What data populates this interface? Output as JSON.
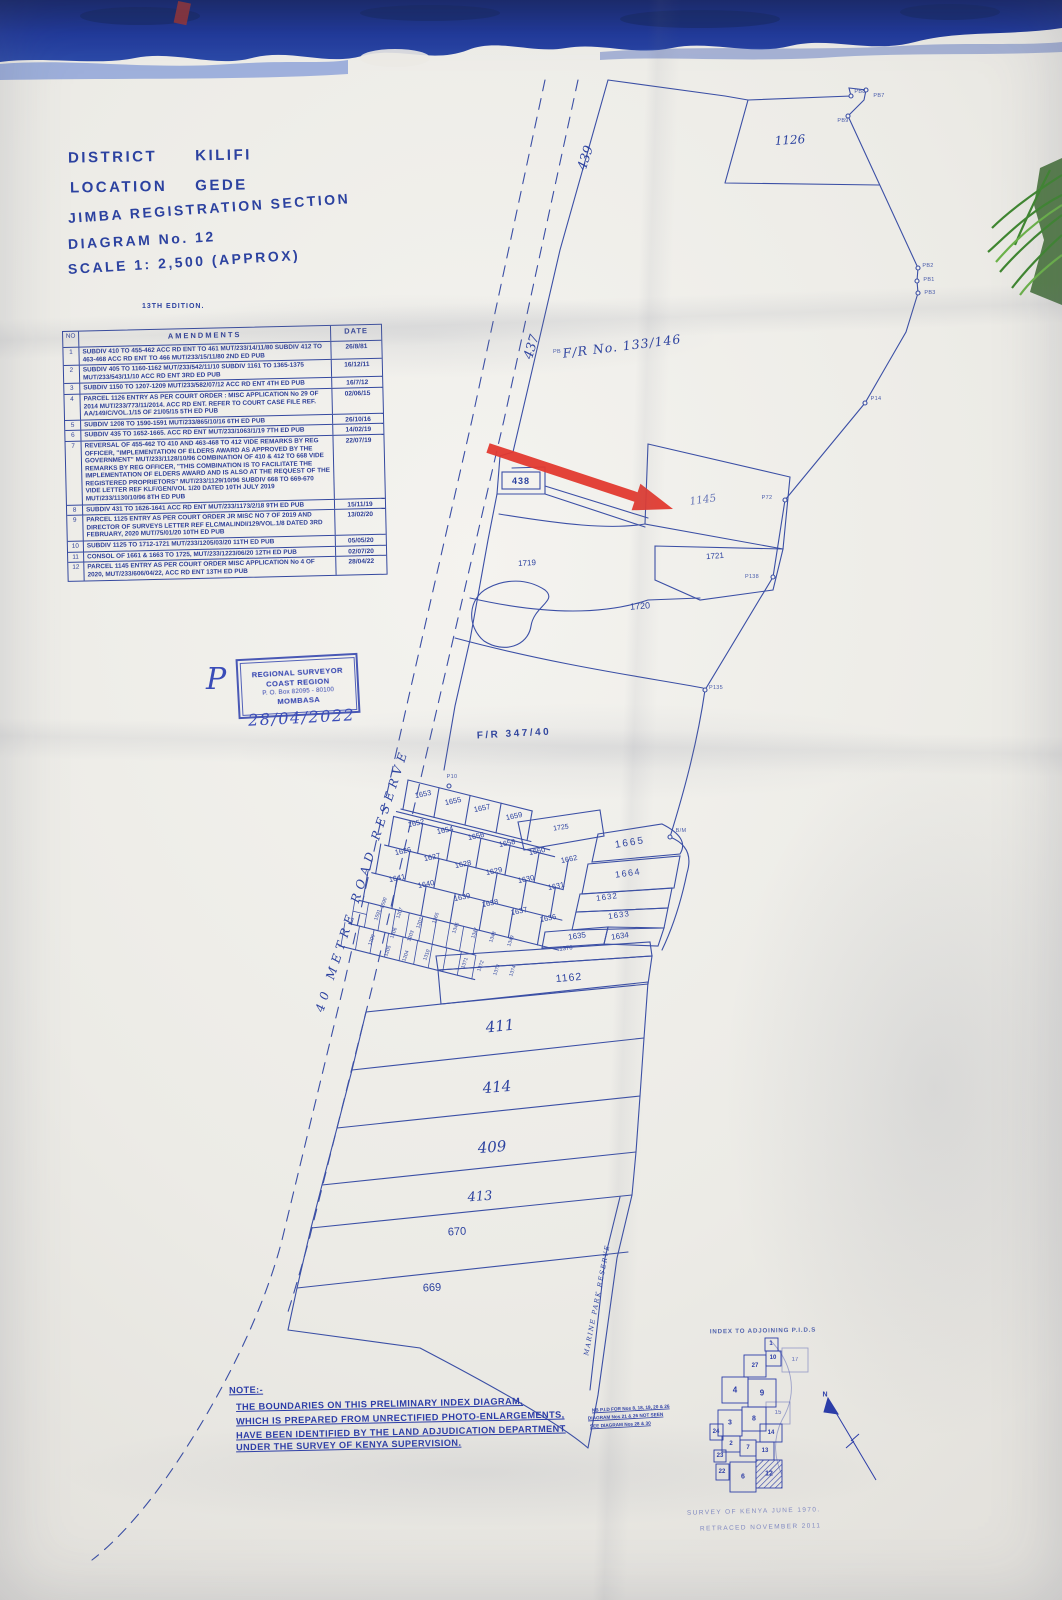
{
  "document": {
    "district_label": "DISTRICT",
    "district_value": "KILIFI",
    "location_label": "LOCATION",
    "location_value": "GEDE",
    "section_line": "JIMBA REGISTRATION SECTION",
    "diagram_line": "DIAGRAM No. 12",
    "scale_line": "SCALE 1: 2,500 (APPROX)",
    "edition": "13TH EDITION."
  },
  "amendments_table": {
    "headers": {
      "no": "NO",
      "amendments": "AMENDMENTS",
      "date": "DATE"
    },
    "rows": [
      {
        "no": "1",
        "text": "SUBDIV 410 TO 455-462 ACC RD ENT TO 461 MUT/233/14/11/80  SUBDIV 412 TO 463-468 ACC RD ENT TO 466 MUT/233/15/11/80   2ND ED PUB",
        "date": "26/8/81"
      },
      {
        "no": "2",
        "text": "SUBDIV 405 TO 1160-1162 MUT/233/542/11/10  SUBDIV 1161 TO 1365-1375 MUT/233/543/11/10  ACC RD ENT   3RD ED PUB",
        "date": "16/12/11"
      },
      {
        "no": "3",
        "text": "SUBDIV 1150 TO 1207-1209 MUT/233/582/07/12  ACC RD ENT   4TH ED PUB",
        "date": "16/7/12"
      },
      {
        "no": "4",
        "text": "PARCEL 1126 ENTRY AS PER COURT ORDER : MISC APPLICATION No 29 OF 2014  MUT/233/773/11/2014. ACC RD ENT. REFER TO COURT CASE FILE REF. AA/149/C/VOL.1/15 OF 21/05/15   5TH ED PUB",
        "date": "02/06/15"
      },
      {
        "no": "5",
        "text": "SUBDIV 1208 TO 1590-1591 MUT/233/865/10/16   6TH ED PUB",
        "date": "26/10/16"
      },
      {
        "no": "6",
        "text": "SUBDIV 435 TO 1652-1665. ACC RD ENT MUT/233/1063/1/19   7TH ED PUB",
        "date": "14/02/19"
      },
      {
        "no": "7",
        "text": "REVERSAL OF 455-462 TO 410 AND 463-468 TO 412 VIDE REMARKS BY REG OFFICER, \"IMPLEMENTATION OF ELDERS AWARD AS APPROVED BY THE GOVERNMENT\" MUT/233/1128/10/96  COMBINATION OF 410 & 412 TO 668 VIDE REMARKS BY REG OFFICER, \"THIS COMBINATION IS TO FACILITATE THE IMPLEMENTATION OF ELDERS AWARD AND IS ALSO AT THE REQUEST OF THE REGISTERED PROPRIETORS\" MUT/233/1129/10/96  SUBDIV 668 TO 669-670 VIDE LETTER REF KLF/GEN/VOL 1/20 DATED 10TH JULY 2019 MUT/233/1130/10/96   8TH ED PUB",
        "date": "22/07/19"
      },
      {
        "no": "8",
        "text": "SUBDIV 431 TO 1626-1641 ACC RD ENT MUT/233/1173/2/18   9TH ED PUB",
        "date": "15/11/19"
      },
      {
        "no": "9",
        "text": "PARCEL 1125 ENTRY AS PER COURT ORDER JR MISC NO 7 OF 2019 AND DIRECTOR OF SURVEYS LETTER REF ELC/MALINDI/129/VOL.1/8 DATED 3RD FEBRUARY, 2020 MUT/75/01/20   10TH ED PUB",
        "date": "13/02/20"
      },
      {
        "no": "10",
        "text": "SUBDIV 1125 TO 1712-1721 MUT/233/1205/03/20   11TH ED PUB",
        "date": "05/05/20"
      },
      {
        "no": "11",
        "text": "CONSOL OF 1661 & 1663 TO 1725, MUT/233/1223/06/20   12TH ED PUB",
        "date": "02/07/20"
      },
      {
        "no": "12",
        "text": "PARCEL 1145 ENTRY AS PER COURT ORDER MISC APPLICATION No 4 OF 2020, MUT/233/606/04/22, ACC RD ENT   13TH ED PUB",
        "date": "28/04/22"
      }
    ]
  },
  "stamp": {
    "line1": "REGIONAL SURVEYOR",
    "line2": "COAST REGION",
    "line3": "P. O. Box 82095 - 80100",
    "line4": "MOMBASA",
    "handwritten_date": "28/04/2022",
    "handwritten_initial": "P"
  },
  "map": {
    "region_labels": {
      "fr_133_146": "F/R No. 133/146",
      "fr_347_40": "F/R  347/40"
    },
    "road_labels": {
      "r439": "439",
      "r437": "437",
      "r438": "438",
      "road_reserve": "40 METRE ROAD RESERVE",
      "marine_reserve": "MARINE PARK RESERVE"
    },
    "parcels": {
      "p1126": "1126",
      "p1145": "1145",
      "p1719": "1719",
      "p1720": "1720",
      "p1721": "1721",
      "p1725": "1725",
      "p1665": "1665",
      "p1664": "1664",
      "p1632": "1632",
      "p1633": "1633",
      "p1634": "1634",
      "p1635": "1635",
      "p1653": "1653",
      "p1655": "1655",
      "p1657": "1657",
      "p1659": "1659",
      "p1652": "1652",
      "p1654": "1654",
      "p1656": "1656",
      "p1658": "1658",
      "p1660": "1660",
      "p1662": "1662",
      "p1626": "1626",
      "p1627": "1627",
      "p1628": "1628",
      "p1629": "1629",
      "p1630": "1630",
      "p1631": "1631",
      "p1641": "1641",
      "p1640": "1640",
      "p1639": "1639",
      "p1638": "1638",
      "p1637": "1637",
      "p1636": "1636",
      "p1376": "1376",
      "p1162": "1162",
      "p411": "411",
      "p414": "414",
      "p409": "409",
      "p413": "413",
      "p670": "670",
      "p669": "669"
    },
    "small_parcels": {
      "s1590": "1590",
      "s1591": "1591",
      "s1207": "1207",
      "s1206": "1206",
      "s1205": "1205",
      "s1204": "1204",
      "s1203": "1203",
      "s1202": "1202",
      "s1209": "1209",
      "s1365": "1365",
      "s1346": "1346",
      "s1347": "1347",
      "s1348": "1348",
      "s1349": "1349",
      "s1310": "1310",
      "s1371": "1371",
      "s1372": "1372",
      "s1373": "1373",
      "s1374": "1374"
    },
    "survey_points": {
      "pb8": "PB8",
      "pb7": "PB7",
      "pb9": "PB9",
      "pb2": "PB2",
      "pb1": "PB1",
      "pb3": "PB3",
      "p14": "P14",
      "p72": "P72",
      "p138": "P138",
      "p135": "P135",
      "p10": "P10",
      "bm": "B/M",
      "pb": "PB"
    }
  },
  "note": {
    "label": "NOTE:-",
    "lines": [
      "THE BOUNDARIES ON THIS PRELIMINARY INDEX DIAGRAM,",
      "WHICH IS PREPARED FROM UNRECTIFIED PHOTO-ENLARGEMENTS,",
      "HAVE BEEN IDENTIFIED BY THE LAND ADJUDICATION DEPARTMENT",
      "UNDER THE SURVEY OF KENYA SUPERVISION."
    ]
  },
  "annotations": {
    "side_note_lines": [
      "NB P.I.D FOR Nos 8, 18, 19, 20 & 26",
      "DIAGRAM Nos 21 & 26 NOT SEEN",
      "SEE DIAGRAM Nos 28 & 30"
    ]
  },
  "index_map": {
    "title": "INDEX TO ADJOINING P.I.D.S",
    "north_label": "N",
    "numbers": {
      "n1": "1",
      "n27": "27",
      "n10": "10",
      "n17": "17",
      "n4": "4",
      "n9": "9",
      "n15": "15",
      "n8": "8",
      "n3": "3",
      "n14": "14",
      "n24": "24",
      "n2": "2",
      "n7": "7",
      "n13": "13",
      "n23": "23",
      "n22": "22",
      "n6": "6",
      "n12": "12"
    }
  },
  "footer": {
    "line1": "SURVEY OF KENYA JUNE 1970.",
    "line2": "RETRACED NOVEMBER 2011"
  },
  "colors": {
    "ink": "#2c42a0",
    "band_blue": "#1d3478",
    "band_light": "#4f74cf",
    "arrow_red": "#e2392f",
    "plant_green": "#2e7d1e",
    "paper": "#edecea"
  }
}
